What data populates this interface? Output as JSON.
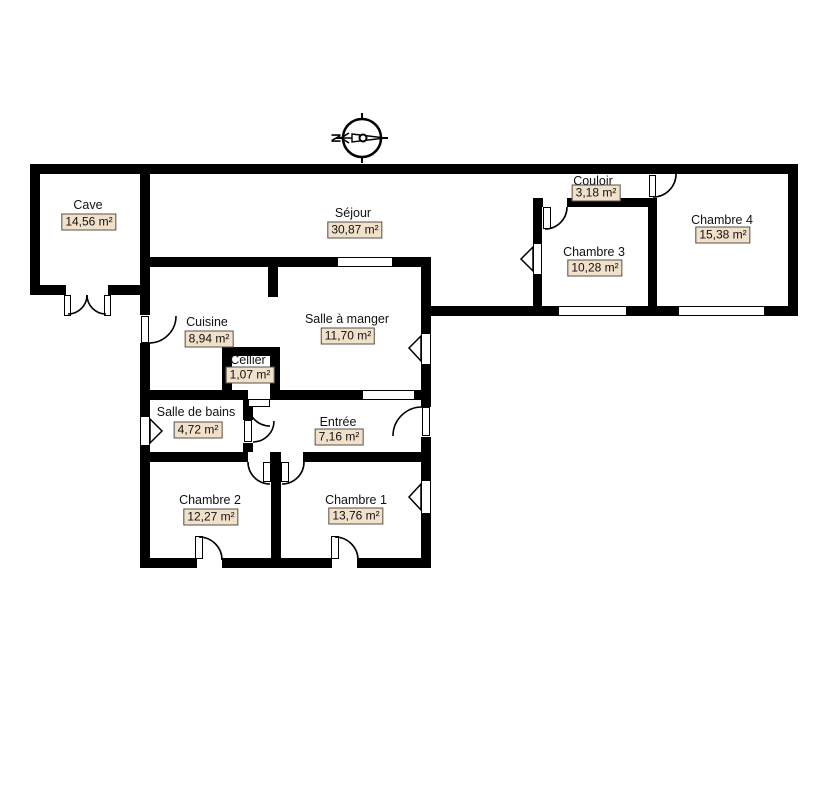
{
  "title": "Plan de maison - rez-de-chaussée",
  "canvas": {
    "width": 827,
    "height": 788
  },
  "colors": {
    "wall": "#000000",
    "background": "#ffffff",
    "area_box_bg": "#f2e1ca",
    "area_box_border": "#55514a",
    "text": "#111111"
  },
  "compass": {
    "letter": "N",
    "cx": 362,
    "cy": 138,
    "r": 19,
    "ticks": [
      [
        362,
        113,
        362,
        120
      ],
      [
        362,
        156,
        362,
        163
      ],
      [
        336,
        138,
        343,
        138
      ],
      [
        381,
        138,
        388,
        138
      ]
    ],
    "needle_line": [
      341,
      138,
      386,
      138
    ],
    "arrowhead": "349,133 341,138 349,143",
    "tail_polygon": "352,134 385,138 352,142",
    "hub": {
      "cx": 363,
      "cy": 138,
      "r": 3.5
    }
  },
  "rooms": [
    {
      "id": "cave",
      "label": "Cave",
      "area": "14,56 m²",
      "lx": 88,
      "ly": 205,
      "bx": 89,
      "by": 222
    },
    {
      "id": "sejour",
      "label": "Séjour",
      "area": "30,87 m²",
      "lx": 353,
      "ly": 213,
      "bx": 355,
      "by": 230
    },
    {
      "id": "couloir",
      "label": "Couloir",
      "area": "3,18 m²",
      "lx": 593,
      "ly": 181,
      "bx": 596,
      "by": 193
    },
    {
      "id": "chambre-3",
      "label": "Chambre 3",
      "area": "10,28 m²",
      "lx": 594,
      "ly": 252,
      "bx": 595,
      "by": 268
    },
    {
      "id": "chambre-4",
      "label": "Chambre 4",
      "area": "15,38 m²",
      "lx": 722,
      "ly": 220,
      "bx": 723,
      "by": 235
    },
    {
      "id": "cuisine",
      "label": "Cuisine",
      "area": "8,94 m²",
      "lx": 207,
      "ly": 322,
      "bx": 209,
      "by": 339
    },
    {
      "id": "salle-a-manger",
      "label": "Salle à manger",
      "area": "11,70 m²",
      "lx": 347,
      "ly": 319,
      "bx": 348,
      "by": 336
    },
    {
      "id": "cellier",
      "label": "Cellier",
      "area": "1,07 m²",
      "lx": 248,
      "ly": 360,
      "bx": 250,
      "by": 375
    },
    {
      "id": "salle-de-bains",
      "label": "Salle de bains",
      "area": "4,72 m²",
      "lx": 196,
      "ly": 412,
      "bx": 198,
      "by": 430
    },
    {
      "id": "entree",
      "label": "Entrée",
      "area": "7,16 m²",
      "lx": 338,
      "ly": 422,
      "bx": 339,
      "by": 437
    },
    {
      "id": "chambre-2",
      "label": "Chambre 2",
      "area": "12,27 m²",
      "lx": 210,
      "ly": 500,
      "bx": 211,
      "by": 517
    },
    {
      "id": "chambre-1",
      "label": "Chambre 1",
      "area": "13,76 m²",
      "lx": 356,
      "ly": 500,
      "bx": 356,
      "by": 516
    }
  ],
  "walls": [
    {
      "name": "wall-top",
      "x": 30,
      "y": 164,
      "w": 768,
      "h": 10
    },
    {
      "name": "wall-right-upper",
      "x": 788,
      "y": 164,
      "w": 10,
      "h": 152
    },
    {
      "name": "wall-band-bottom",
      "x": 421,
      "y": 306,
      "w": 377,
      "h": 10
    },
    {
      "name": "wall-cave-left",
      "x": 30,
      "y": 164,
      "w": 10,
      "h": 131
    },
    {
      "name": "wall-cave-bottom",
      "x": 30,
      "y": 285,
      "w": 118,
      "h": 10
    },
    {
      "name": "wall-left-main",
      "x": 140,
      "y": 164,
      "w": 10,
      "h": 404
    },
    {
      "name": "wall-sejour-bottom",
      "x": 148,
      "y": 257,
      "w": 283,
      "h": 10
    },
    {
      "name": "wall-right-lower",
      "x": 421,
      "y": 257,
      "w": 10,
      "h": 311
    },
    {
      "name": "wall-chambre3-left",
      "x": 533,
      "y": 198,
      "w": 9,
      "h": 118
    },
    {
      "name": "wall-chambre3-top",
      "x": 533,
      "y": 198,
      "w": 124,
      "h": 9
    },
    {
      "name": "wall-chambre4-left",
      "x": 648,
      "y": 164,
      "w": 9,
      "h": 152
    },
    {
      "name": "wall-kitchen-stub",
      "x": 268,
      "y": 267,
      "w": 10,
      "h": 30
    },
    {
      "name": "wall-cellier-left",
      "x": 222,
      "y": 347,
      "w": 10,
      "h": 43
    },
    {
      "name": "wall-cellier-top",
      "x": 222,
      "y": 347,
      "w": 58,
      "h": 9
    },
    {
      "name": "wall-cellier-right",
      "x": 270,
      "y": 347,
      "w": 10,
      "h": 43
    },
    {
      "name": "wall-mid-row",
      "x": 140,
      "y": 390,
      "w": 291,
      "h": 10
    },
    {
      "name": "wall-bath-divider",
      "x": 243,
      "y": 400,
      "w": 10,
      "h": 52
    },
    {
      "name": "wall-entree-bottom",
      "x": 140,
      "y": 452,
      "w": 291,
      "h": 10
    },
    {
      "name": "wall-bedroom-divider",
      "x": 271,
      "y": 452,
      "w": 10,
      "h": 116
    },
    {
      "name": "wall-bottom",
      "x": 140,
      "y": 558,
      "w": 291,
      "h": 10
    }
  ],
  "door_gaps": [
    {
      "name": "gap-cave-door",
      "x": 66,
      "y": 285,
      "w": 42,
      "h": 10
    },
    {
      "name": "gap-cuisine-door",
      "x": 140,
      "y": 315,
      "w": 10,
      "h": 28
    },
    {
      "name": "gap-chambre4-door",
      "x": 648,
      "y": 174,
      "w": 9,
      "h": 24
    },
    {
      "name": "gap-chambre3-door",
      "x": 543,
      "y": 198,
      "w": 24,
      "h": 9
    },
    {
      "name": "gap-cellier-door",
      "x": 248,
      "y": 390,
      "w": 22,
      "h": 10
    },
    {
      "name": "gap-bain-door",
      "x": 243,
      "y": 420,
      "w": 10,
      "h": 23
    },
    {
      "name": "gap-entree-door",
      "x": 421,
      "y": 407,
      "w": 10,
      "h": 30
    },
    {
      "name": "gap-chambre2-door",
      "x": 248,
      "y": 452,
      "w": 22,
      "h": 10
    },
    {
      "name": "gap-chambre1-door",
      "x": 281,
      "y": 452,
      "w": 22,
      "h": 10
    },
    {
      "name": "gap-chambre2-door-sud",
      "x": 197,
      "y": 558,
      "w": 25,
      "h": 10
    },
    {
      "name": "gap-chambre1-door-sud",
      "x": 332,
      "y": 558,
      "w": 25,
      "h": 10
    }
  ],
  "windows": [
    {
      "name": "window-chambre3-sud",
      "x": 558,
      "y": 306,
      "w": 69,
      "h": 10
    },
    {
      "name": "window-chambre4-sud",
      "x": 678,
      "y": 306,
      "w": 87,
      "h": 10
    },
    {
      "name": "window-salle-a-manger-est",
      "x": 421,
      "y": 333,
      "w": 10,
      "h": 32
    },
    {
      "name": "window-chambre1-est",
      "x": 421,
      "y": 480,
      "w": 10,
      "h": 34
    },
    {
      "name": "window-salle-de-bains-ouest",
      "x": 140,
      "y": 416,
      "w": 10,
      "h": 30
    },
    {
      "name": "window-chambre3-ouest",
      "x": 533,
      "y": 243,
      "w": 9,
      "h": 32
    },
    {
      "name": "passage-sejour-salle-a-manger",
      "x": 337,
      "y": 257,
      "w": 56,
      "h": 10
    },
    {
      "name": "passage-salle-a-manger-entree",
      "x": 362,
      "y": 390,
      "w": 53,
      "h": 10
    }
  ],
  "door_leaves": [
    {
      "name": "leaf-cave-gauche",
      "x": 64,
      "y": 295,
      "w": 7,
      "h": 21
    },
    {
      "name": "leaf-cave-droite",
      "x": 104,
      "y": 295,
      "w": 7,
      "h": 21
    },
    {
      "name": "leaf-cuisine",
      "x": 141,
      "y": 316,
      "w": 8,
      "h": 27
    },
    {
      "name": "leaf-chambre4",
      "x": 649,
      "y": 175,
      "w": 7,
      "h": 22
    },
    {
      "name": "leaf-chambre3",
      "x": 543,
      "y": 207,
      "w": 8,
      "h": 22
    },
    {
      "name": "leaf-cellier",
      "x": 248,
      "y": 399,
      "w": 22,
      "h": 8
    },
    {
      "name": "leaf-salle-de-bains",
      "x": 244,
      "y": 420,
      "w": 8,
      "h": 22
    },
    {
      "name": "leaf-entree",
      "x": 422,
      "y": 407,
      "w": 8,
      "h": 29
    },
    {
      "name": "leaf-chambre2-nord",
      "x": 263,
      "y": 462,
      "w": 8,
      "h": 20
    },
    {
      "name": "leaf-chambre1-nord",
      "x": 281,
      "y": 462,
      "w": 8,
      "h": 20
    },
    {
      "name": "leaf-chambre2-sud",
      "x": 195,
      "y": 536,
      "w": 8,
      "h": 23
    },
    {
      "name": "leaf-chambre1-sud",
      "x": 331,
      "y": 536,
      "w": 8,
      "h": 23
    }
  ],
  "door_arcs": [
    {
      "name": "arc-cave-gauche",
      "d": "M 87,295 A 19 19 0 0 1 68,314"
    },
    {
      "name": "arc-cave-droite",
      "d": "M 87,295 A 19 19 0 0 0 106,314"
    },
    {
      "name": "arc-cuisine",
      "d": "M 149,343 A 27 27 0 0 0 176,316"
    },
    {
      "name": "arc-chambre4",
      "d": "M 653,197 A 23 23 0 0 0 676,174"
    },
    {
      "name": "arc-chambre3",
      "d": "M 545,229 A 22 22 0 0 0 567,207"
    },
    {
      "name": "arc-cellier",
      "d": "M 248,404 A 22 22 0 0 0 270,426"
    },
    {
      "name": "arc-salle-de-bains",
      "d": "M 253,442 A 21 21 0 0 0 274,421"
    },
    {
      "name": "arc-entree",
      "d": "M 422,407 A 29 29 0 0 0 393,436"
    },
    {
      "name": "arc-chambre2-nord",
      "d": "M 248,462 A 22 22 0 0 0 270,484"
    },
    {
      "name": "arc-chambre1-nord",
      "d": "M 304,462 A 22 22 0 0 1 282,484"
    },
    {
      "name": "arc-chambre2-sud",
      "d": "M 199,537 A 23 23 0 0 1 222,560"
    },
    {
      "name": "arc-chambre1-sud",
      "d": "M 335,537 A 23 23 0 0 1 358,560"
    }
  ],
  "window_arrows": [
    {
      "name": "arrow-salle-a-manger-est",
      "points": "421,336 409,348 421,361"
    },
    {
      "name": "arrow-chambre1-est",
      "points": "421,484 409,497 421,510"
    },
    {
      "name": "arrow-salle-de-bains-ouest",
      "points": "150,419 162,431 150,443"
    },
    {
      "name": "arrow-chambre3-ouest",
      "points": "533,247 521,259 533,271"
    }
  ]
}
